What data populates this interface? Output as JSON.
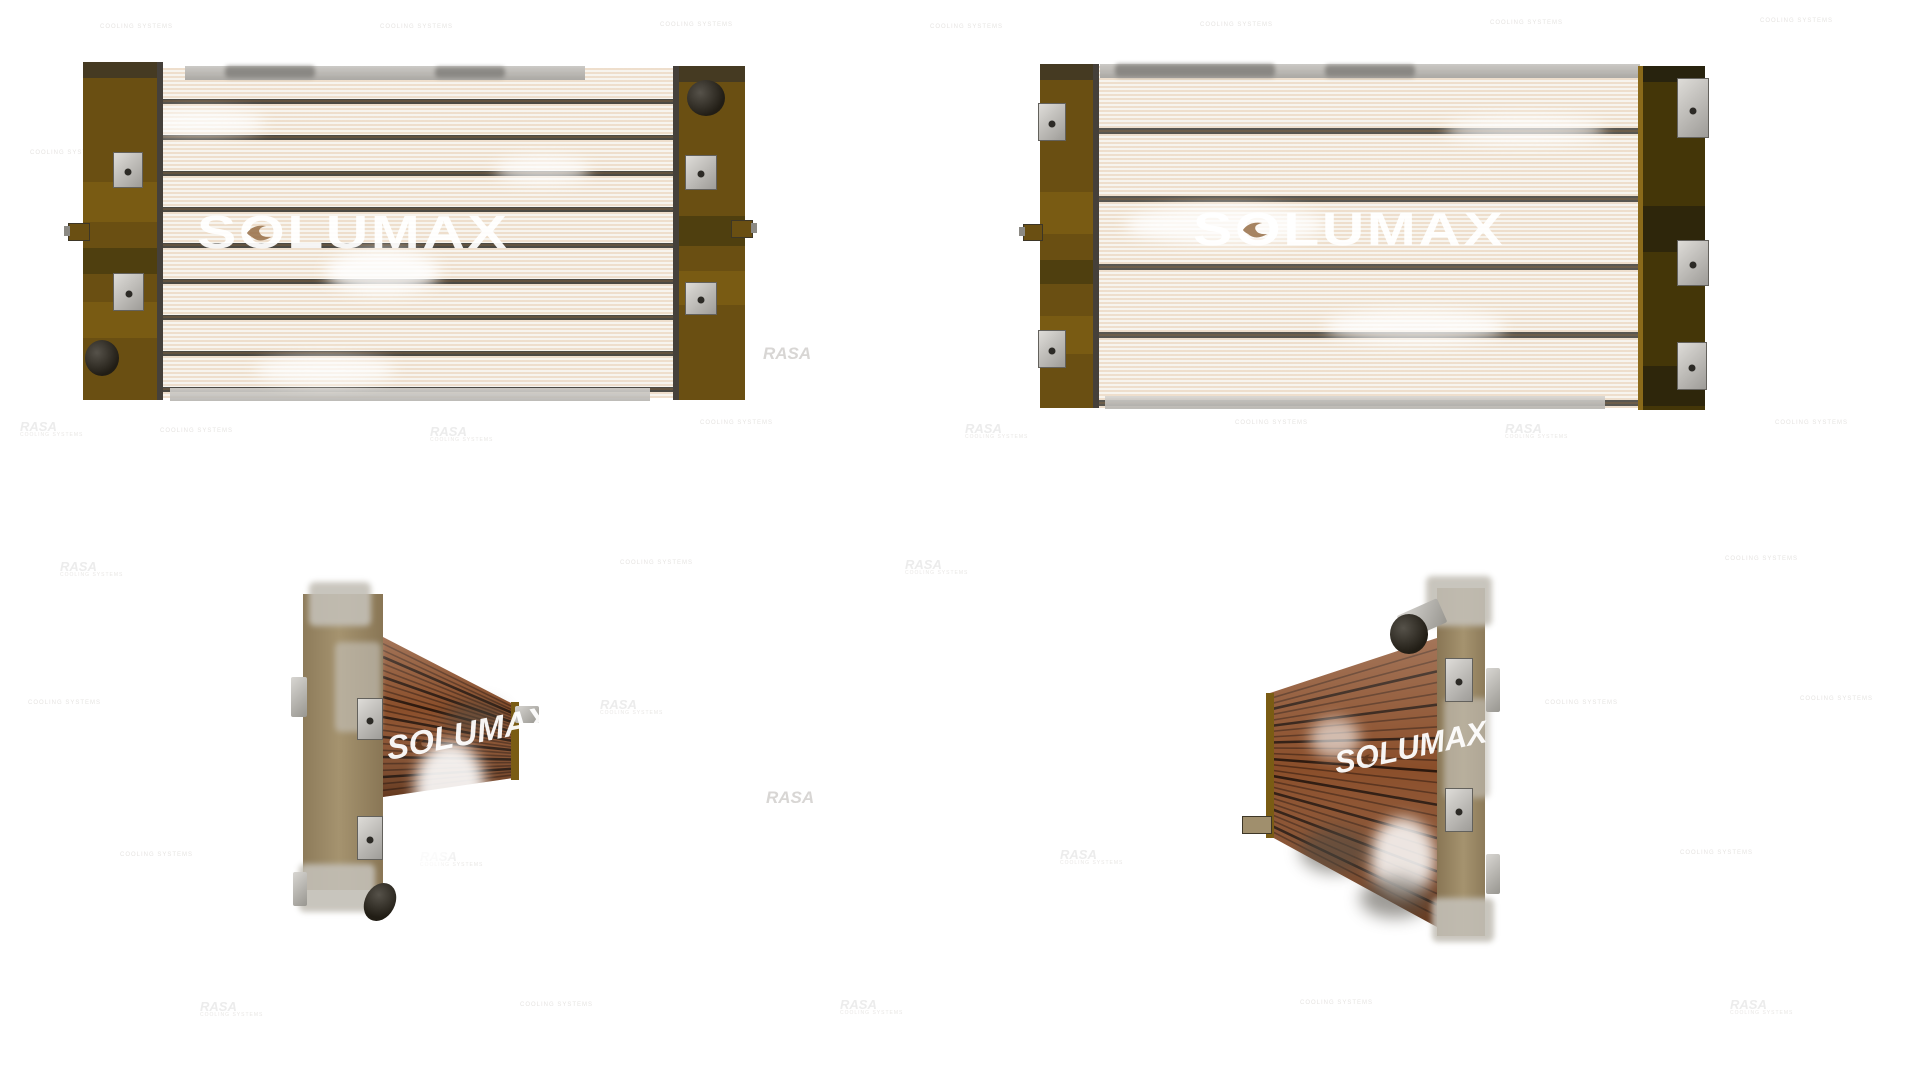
{
  "brand": {
    "watermark": "SOLUMAX",
    "tile_watermark": "RASA",
    "tile_subtext": "COOLING SYSTEMS"
  },
  "colors": {
    "background": "#ffffff",
    "tank_brown": "#6a4f12",
    "tank_dark_brown": "#443608",
    "core_ivory": "#f7f4ee",
    "fin_orange": "#c6823e",
    "core_copper": "#8a4e2a",
    "copper_line": "#23120a",
    "metal_silver": "#c3bfb6",
    "watermark_white": "#ffffff",
    "ghost_gray": "#d8d6d4"
  },
  "figures": [
    {
      "id": "radiator-front-view-left",
      "watermark": "SOLUMAX"
    },
    {
      "id": "radiator-front-view-right",
      "watermark": "SOLUMAX"
    },
    {
      "id": "radiator-three-quarter-left",
      "watermark": "SOLUMAX"
    },
    {
      "id": "radiator-three-quarter-right",
      "watermark": "SOLUMAX"
    }
  ],
  "scatter": {
    "items": [
      {
        "x": 763,
        "y": 344,
        "k": "tile-strong"
      },
      {
        "x": 766,
        "y": 788,
        "k": "tile-strong"
      },
      {
        "x": 84,
        "y": 64,
        "k": "ghost"
      },
      {
        "x": 84,
        "y": 306,
        "k": "ghost"
      },
      {
        "x": 1042,
        "y": 310,
        "k": "ghost"
      },
      {
        "x": 100,
        "y": 24,
        "k": "sub"
      },
      {
        "x": 380,
        "y": 24,
        "k": "sub"
      },
      {
        "x": 660,
        "y": 22,
        "k": "sub"
      },
      {
        "x": 930,
        "y": 24,
        "k": "sub"
      },
      {
        "x": 1200,
        "y": 22,
        "k": "sub"
      },
      {
        "x": 1490,
        "y": 20,
        "k": "sub"
      },
      {
        "x": 1760,
        "y": 18,
        "k": "sub"
      },
      {
        "x": 30,
        "y": 150,
        "k": "sub"
      },
      {
        "x": 20,
        "y": 420,
        "k": "tile"
      },
      {
        "x": 160,
        "y": 428,
        "k": "sub"
      },
      {
        "x": 430,
        "y": 425,
        "k": "tile"
      },
      {
        "x": 700,
        "y": 420,
        "k": "sub"
      },
      {
        "x": 965,
        "y": 422,
        "k": "tile"
      },
      {
        "x": 1235,
        "y": 420,
        "k": "sub"
      },
      {
        "x": 1505,
        "y": 422,
        "k": "tile"
      },
      {
        "x": 1775,
        "y": 420,
        "k": "sub"
      },
      {
        "x": 60,
        "y": 560,
        "k": "tile"
      },
      {
        "x": 620,
        "y": 560,
        "k": "sub"
      },
      {
        "x": 905,
        "y": 558,
        "k": "tile"
      },
      {
        "x": 1725,
        "y": 556,
        "k": "sub"
      },
      {
        "x": 28,
        "y": 700,
        "k": "sub"
      },
      {
        "x": 600,
        "y": 698,
        "k": "tile"
      },
      {
        "x": 1545,
        "y": 700,
        "k": "sub"
      },
      {
        "x": 1800,
        "y": 696,
        "k": "sub"
      },
      {
        "x": 120,
        "y": 852,
        "k": "sub"
      },
      {
        "x": 420,
        "y": 850,
        "k": "tile"
      },
      {
        "x": 1060,
        "y": 848,
        "k": "tile"
      },
      {
        "x": 1680,
        "y": 850,
        "k": "sub"
      },
      {
        "x": 200,
        "y": 1000,
        "k": "tile"
      },
      {
        "x": 520,
        "y": 1002,
        "k": "sub"
      },
      {
        "x": 840,
        "y": 998,
        "k": "tile"
      },
      {
        "x": 1300,
        "y": 1000,
        "k": "sub"
      },
      {
        "x": 1730,
        "y": 998,
        "k": "tile"
      },
      {
        "x": 200,
        "y": 88,
        "k": "core-text"
      },
      {
        "x": 390,
        "y": 135,
        "k": "core-text"
      },
      {
        "x": 300,
        "y": 233,
        "k": "core-text"
      },
      {
        "x": 520,
        "y": 190,
        "k": "core-text"
      },
      {
        "x": 250,
        "y": 300,
        "k": "core-text"
      },
      {
        "x": 1150,
        "y": 88,
        "k": "core-text"
      },
      {
        "x": 1450,
        "y": 88,
        "k": "core-text"
      },
      {
        "x": 1260,
        "y": 188,
        "k": "core-text"
      },
      {
        "x": 1560,
        "y": 190,
        "k": "core-text"
      },
      {
        "x": 1350,
        "y": 233,
        "k": "core-text"
      },
      {
        "x": 1180,
        "y": 306,
        "k": "core-text"
      }
    ]
  }
}
